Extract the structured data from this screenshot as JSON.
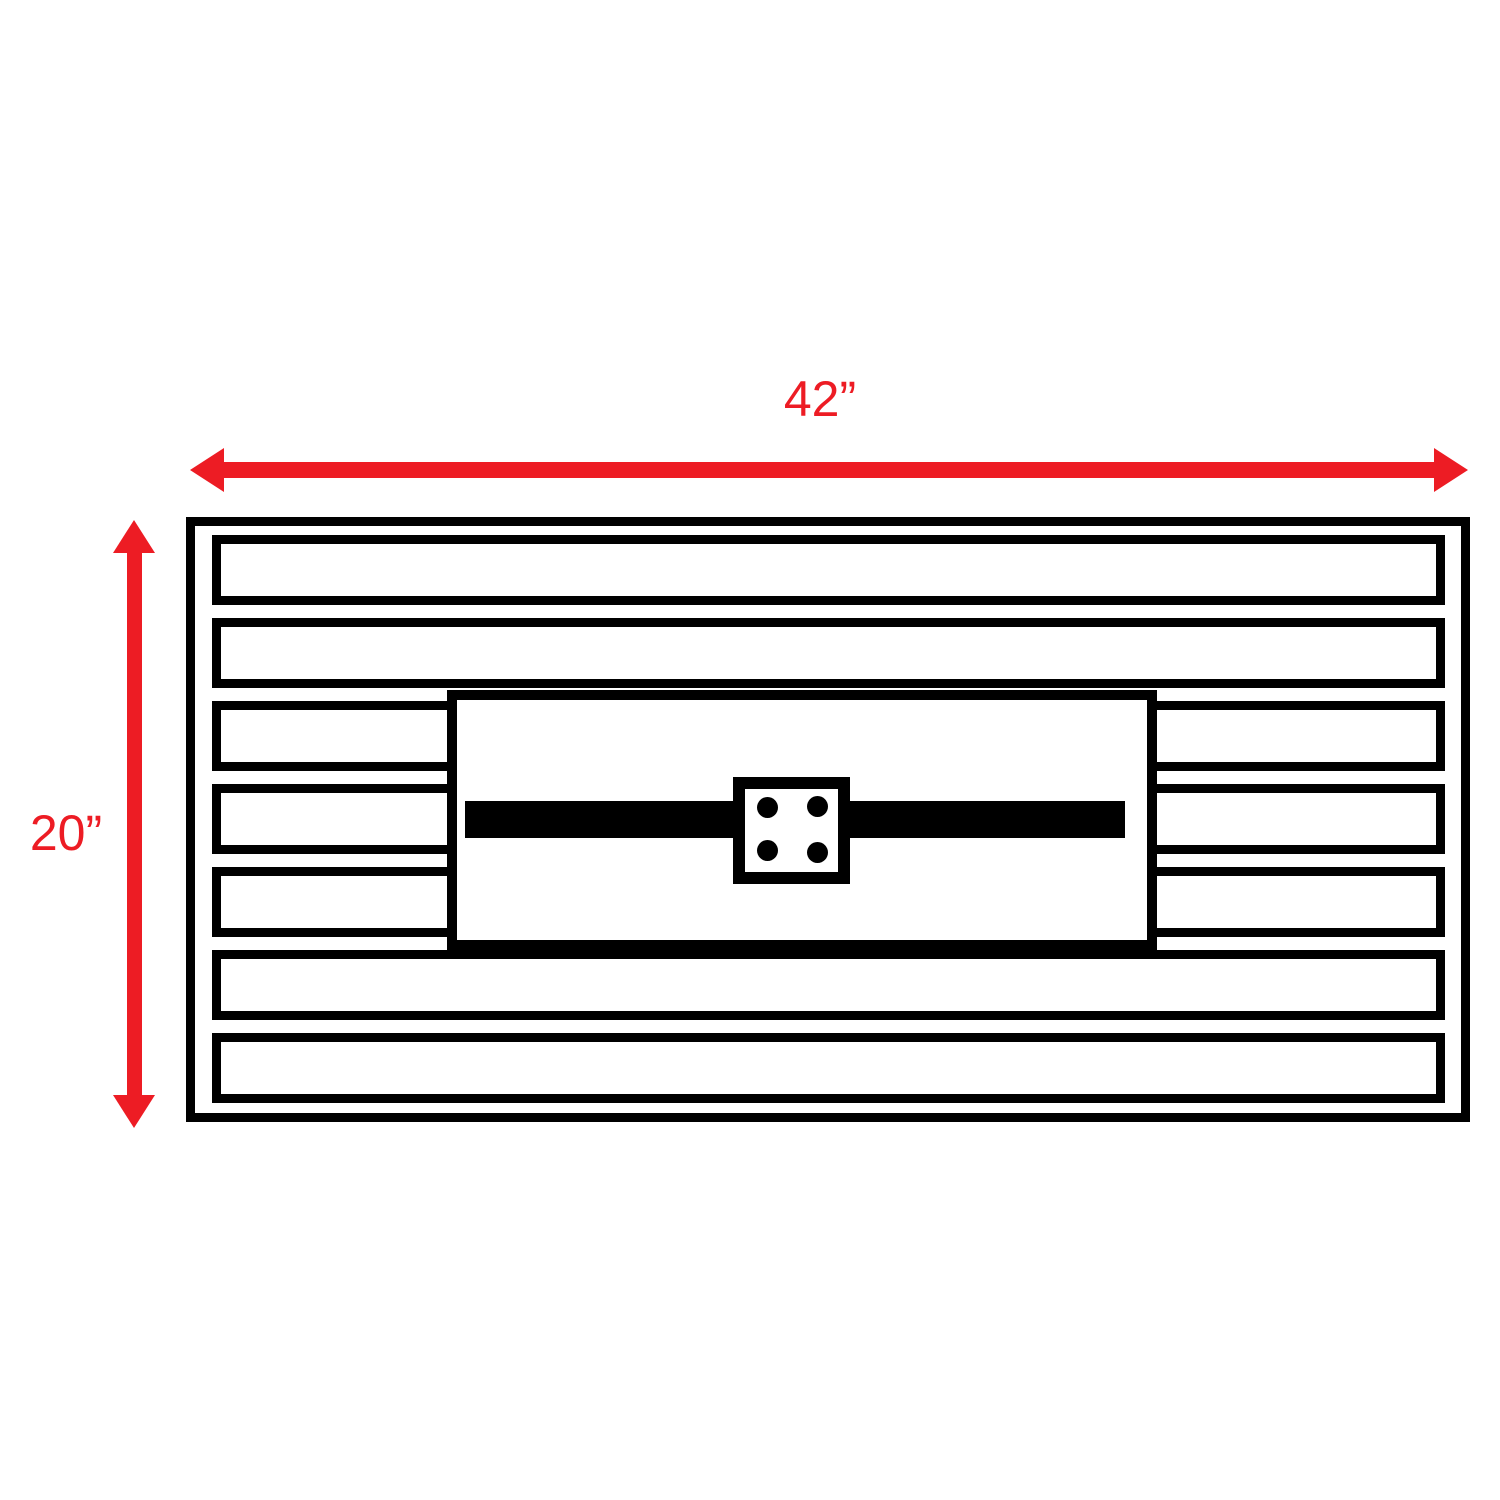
{
  "diagram": {
    "width_dimension": {
      "label": "42”"
    },
    "height_dimension": {
      "label": "20”"
    },
    "slat_count": 7,
    "center_plate": {
      "dot_count": 4
    },
    "colors": {
      "dimension_red": "#ed1c24",
      "line_black": "#000000",
      "background": "#ffffff"
    }
  }
}
